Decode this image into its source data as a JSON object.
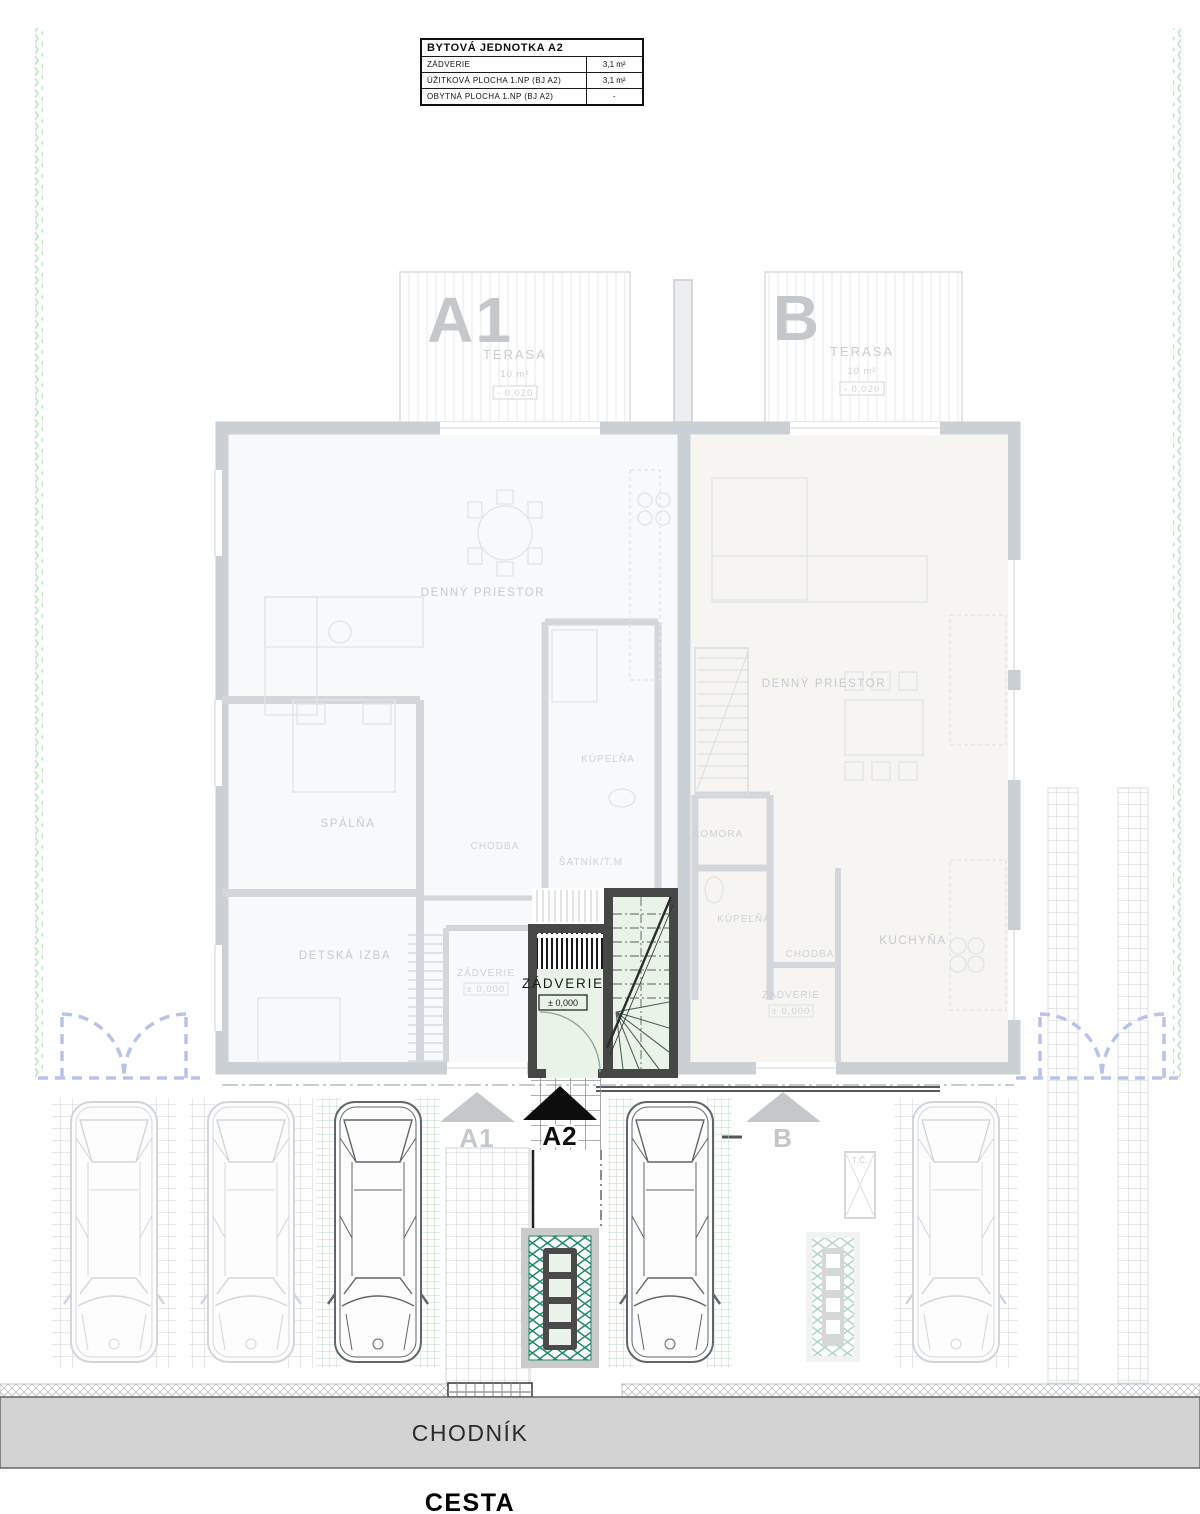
{
  "legend_table": {
    "title": "BYTOVÁ JEDNOTKA A2",
    "rows": [
      {
        "label": "ZÁDVERIE",
        "value": "3,1 m²"
      },
      {
        "label": "ÚŽITKOVÁ PLOCHA 1.NP (BJ A2)",
        "value": "3,1 m²"
      },
      {
        "label": "OBYTNÁ PLOCHA 1.NP (BJ A2)",
        "value": "-"
      }
    ]
  },
  "unit_a1": {
    "big_label": "A1",
    "terrace_name": "TERASA",
    "terrace_area": "10 m²",
    "terrace_level": "- 0,020",
    "living": "DENNÝ PRIESTOR",
    "bedroom": "SPÁLŇA",
    "kids_room": "DETSKÁ IZBA",
    "hall": "CHODBA",
    "bath": "KÚPEĽŇA",
    "wardrobe": "ŠATNÍK/T.M",
    "entry": "ZÁDVERIE",
    "entry_level": "± 0,000"
  },
  "unit_a2": {
    "entry": "ZÁDVERIE",
    "entry_level": "± 0,000"
  },
  "unit_b": {
    "big_label": "B",
    "terrace_name": "TERASA",
    "terrace_area": "10 m²",
    "terrace_level": "- 0,020",
    "living": "DENNÝ PRIESTOR",
    "pantry": "KOMORA",
    "bath": "KÚPEĽŇA",
    "hall": "CHODBA",
    "entry": "ZÁDVERIE",
    "entry_level": "± 0,000",
    "kitchen": "KUCHYŇA"
  },
  "markers": {
    "a1": "A1",
    "a2": "A2",
    "b": "B"
  },
  "site": {
    "sidewalk": "CHODNÍK",
    "road": "CESTA",
    "heat_pump": "T.Č."
  },
  "colors": {
    "highlight_fill": "#e9f3e8",
    "highlight_wall": "#474747",
    "faded_line": "#cbd0d4",
    "boundary_green": "#b9e7b9",
    "pattern_green": "#1f8a66",
    "sidewalk_gray": "#d3d3d3",
    "gate_blue": "#b7c3ea"
  }
}
